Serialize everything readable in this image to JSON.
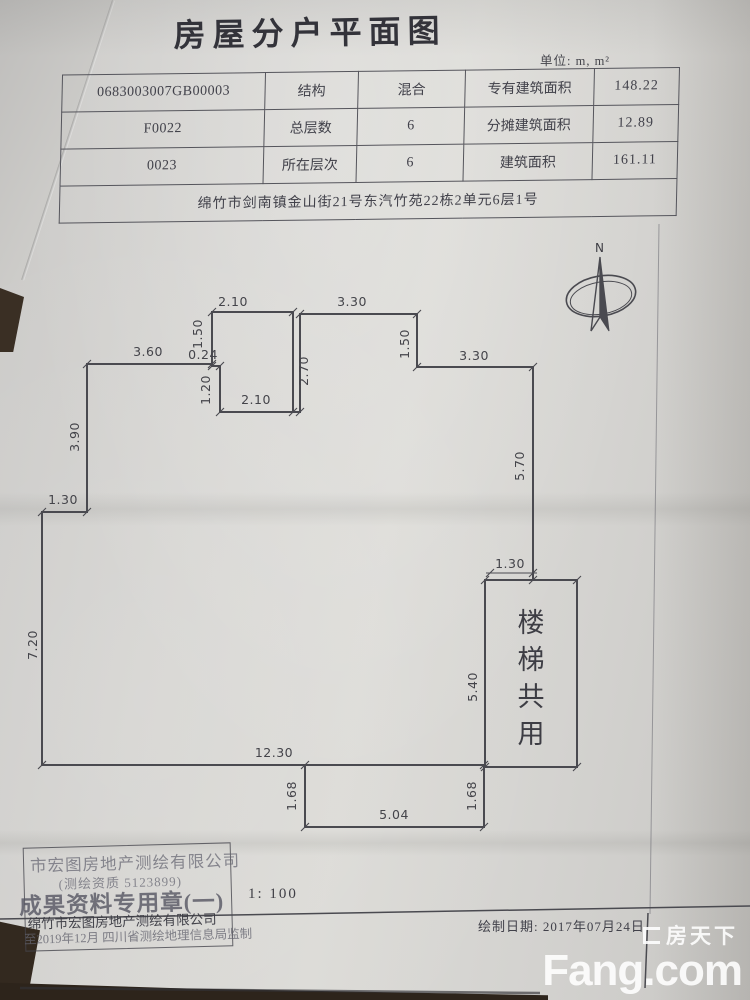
{
  "doc": {
    "title": "房屋分户平面图",
    "unit_label": "单位: m, m²"
  },
  "info_table": {
    "rows": [
      {
        "id": "0683003007GB00003",
        "label": "结构",
        "value": "混合",
        "area_label": "专有建筑面积",
        "area_value": "148.22"
      },
      {
        "id": "F0022",
        "label": "总层数",
        "value": "6",
        "area_label": "分摊建筑面积",
        "area_value": "12.89"
      },
      {
        "id": "0023",
        "label": "所在层次",
        "value": "6",
        "area_label": "建筑面积",
        "area_value": "161.11"
      }
    ],
    "address": "绵竹市剑南镇金山街21号东汽竹苑22栋2单元6层1号"
  },
  "compass": {
    "north_label": "N"
  },
  "floor_plan": {
    "scale_px_per_m": 29.3,
    "stairs_label": "楼梯共用",
    "stairs_chars": [
      "楼",
      "梯",
      "共",
      "用"
    ],
    "dimensions": [
      {
        "t": "2.10",
        "x": 233,
        "y": 306,
        "r": 0
      },
      {
        "t": "3.30",
        "x": 352,
        "y": 306,
        "r": 0
      },
      {
        "t": "1.50",
        "x": 202,
        "y": 334,
        "r": -90
      },
      {
        "t": "2.70",
        "x": 308,
        "y": 371,
        "r": -90
      },
      {
        "t": "1.50",
        "x": 409,
        "y": 344,
        "r": -90
      },
      {
        "t": "3.60",
        "x": 148,
        "y": 356,
        "r": 0
      },
      {
        "t": "0.24",
        "x": 203,
        "y": 359,
        "r": 0
      },
      {
        "t": "1.20",
        "x": 210,
        "y": 390,
        "r": -90
      },
      {
        "t": "2.10",
        "x": 256,
        "y": 404,
        "r": 0
      },
      {
        "t": "3.30",
        "x": 474,
        "y": 360,
        "r": 0
      },
      {
        "t": "3.90",
        "x": 79,
        "y": 437,
        "r": -90
      },
      {
        "t": "5.70",
        "x": 524,
        "y": 466,
        "r": -90
      },
      {
        "t": "1.30",
        "x": 63,
        "y": 504,
        "r": 0
      },
      {
        "t": "7.20",
        "x": 37,
        "y": 645,
        "r": -90
      },
      {
        "t": "1.30",
        "x": 510,
        "y": 568,
        "r": 0
      },
      {
        "t": "5.40",
        "x": 477,
        "y": 687,
        "r": -90
      },
      {
        "t": "12.30",
        "x": 274,
        "y": 757,
        "r": 0
      },
      {
        "t": "1.68",
        "x": 296,
        "y": 796,
        "r": -90
      },
      {
        "t": "1.68",
        "x": 476,
        "y": 796,
        "r": -90
      },
      {
        "t": "5.04",
        "x": 394,
        "y": 819,
        "r": 0
      }
    ]
  },
  "footer": {
    "scale": "1: 100",
    "draw_date": "绘制日期: 2017年07月24日",
    "stamp": {
      "line1": "市宏图房地产测绘有限公司",
      "line2": "(测绘资质 5123899)",
      "line3": "成果资料专用章(一)",
      "line4": "绵竹市宏图房地产测绘有限公司",
      "line5": "至2019年12月 四川省测绘地理信息局监制"
    }
  },
  "watermark": {
    "cn": "房天下",
    "en": "Fang.com"
  },
  "colors": {
    "paper": "#d5d4d1",
    "ink": "#4a4a50",
    "background_dark": "#33291f",
    "watermark": "#ffffff"
  }
}
